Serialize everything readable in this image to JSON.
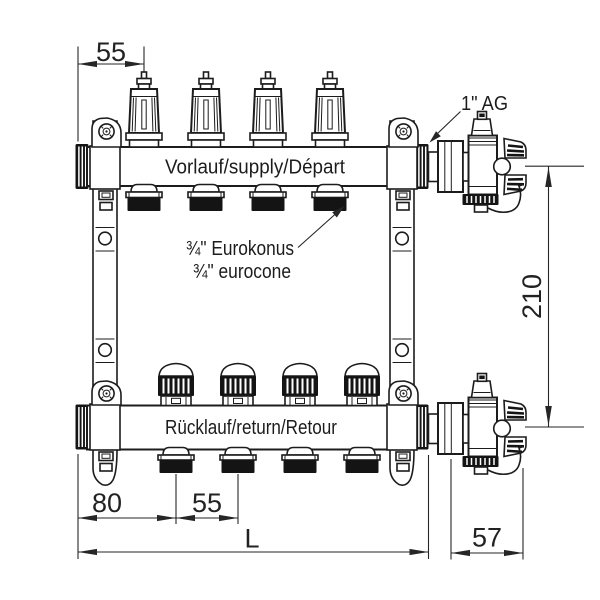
{
  "drawing": {
    "supply_label": "Vorlauf/supply/Départ",
    "return_label": "Rücklauf/return/Retour",
    "connection_label": "1\" AG",
    "eurocone_label_de": "¾\" Eurokonus",
    "eurocone_label_en": "¾\" eurocone",
    "dim_valve_spacing_top": "55",
    "dim_height": "210",
    "dim_end_offset": "80",
    "dim_outlet_spacing": "55",
    "dim_total_length": "L",
    "dim_valve_depth": "57",
    "colors": {
      "line": "#1c1c1c",
      "dark_fill": "#141414",
      "muted_text": "#5a5a5a",
      "background": "#ffffff"
    }
  }
}
